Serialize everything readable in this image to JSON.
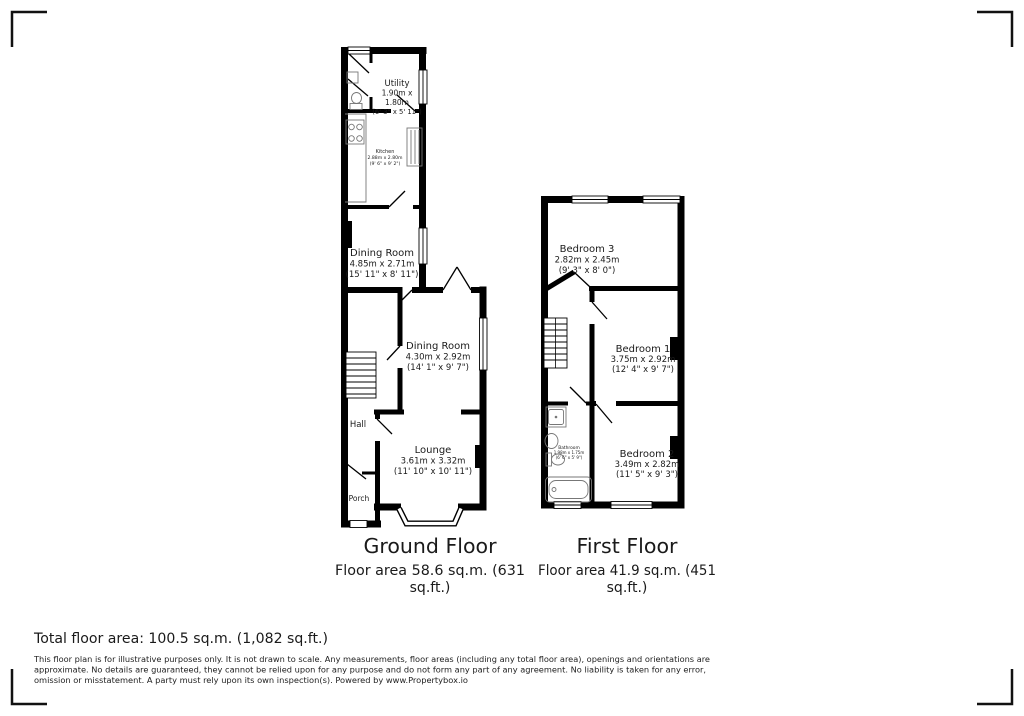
{
  "ground_floor": {
    "title": "Ground Floor",
    "area_line1": "Floor area 58.6 sq.m. (631",
    "area_line2": "sq.ft.)",
    "rooms": {
      "utility": {
        "name": "Utility",
        "dim1": "1.90m x",
        "dim2": "1.80m",
        "imperial": "(6' 3\" x 5' 11\")"
      },
      "kitchen": {
        "name": "Kitchen",
        "metric": "2.88m x 2.80m",
        "imperial": "(9' 6\" x 9' 2\")"
      },
      "dining_room_1": {
        "name": "Dining Room",
        "metric": "4.85m x 2.71m",
        "imperial": "(15' 11\" x 8' 11\")"
      },
      "dining_room_2": {
        "name": "Dining Room",
        "metric": "4.30m x 2.92m",
        "imperial": "(14' 1\" x 9' 7\")"
      },
      "hall": {
        "name": "Hall"
      },
      "lounge": {
        "name": "Lounge",
        "metric": "3.61m x 3.32m",
        "imperial": "(11' 10\" x 10' 11\")"
      },
      "porch": {
        "name": "Porch"
      }
    }
  },
  "first_floor": {
    "title": "First Floor",
    "area_line1": "Floor area 41.9 sq.m. (451",
    "area_line2": "sq.ft.)",
    "rooms": {
      "bedroom_3": {
        "name": "Bedroom 3",
        "metric": "2.82m x 2.45m",
        "imperial": "(9' 3\" x 8' 0\")"
      },
      "bedroom_1": {
        "name": "Bedroom 1",
        "metric": "3.75m x 2.92m",
        "imperial": "(12' 4\" x 9' 7\")"
      },
      "bathroom": {
        "name": "Bathroom",
        "metric": "1.98m x 1.75m",
        "imperial": "(6' 6\" x 5' 9\")"
      },
      "bedroom_2": {
        "name": "Bedroom 2",
        "metric": "3.49m x 2.82m",
        "imperial": "(11' 5\" x 9' 3\")"
      }
    }
  },
  "footer": {
    "total_area": "Total floor area: 100.5 sq.m. (1,082 sq.ft.)",
    "disclaimer_line1": "This floor plan is for illustrative purposes only. It is not drawn to scale. Any measurements, floor areas (including any total floor area), openings and orientations are",
    "disclaimer_line2": "approximate. No details are guaranteed, they cannot be relied upon for any purpose and do not form any part of any agreement. No liability is taken for any error,",
    "disclaimer_line3": "omission or misstatement. A party must rely upon its own inspection(s). Powered by www.Propertybox.io"
  },
  "colors": {
    "wall": "#000000",
    "text": "#1a1a1a",
    "fixture": "#777777"
  }
}
